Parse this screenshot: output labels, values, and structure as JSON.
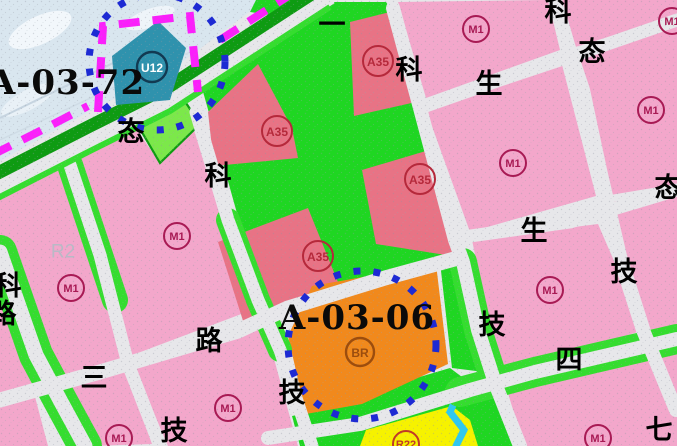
{
  "palette": {
    "road": "#e7e7ea",
    "pink": "#f3a7cb",
    "red": "#e87385",
    "green": "#1fd622",
    "lgreen": "#7ce84a",
    "strip-green": "#35dd2f",
    "dgreen": "#0e9b12",
    "orange": "#f1891c",
    "teal": "#2f92ad",
    "yellow": "#f6f200",
    "cyan": "#2fc8f0",
    "magenta": "#fb1ffb",
    "blue": "#1d2ad3",
    "icy": "#d9e6ef",
    "m1-ink": "#a81a54",
    "a35-ink": "#b5293b",
    "br-ink": "#9c4d0e",
    "u12-ink": "#123a52",
    "r22-ink": "#c03a28",
    "char-ink": "#000000"
  },
  "zone_callouts": [
    {
      "id": "A-03-72",
      "x": 67,
      "y": 83
    },
    {
      "id": "A-03-06",
      "x": 357,
      "y": 318
    }
  ],
  "road_name_chars": [
    {
      "ch": "一",
      "x": 332,
      "y": 25
    },
    {
      "ch": "态",
      "x": 131,
      "y": 132
    },
    {
      "ch": "科",
      "x": 409,
      "y": 70
    },
    {
      "ch": "科",
      "x": 558,
      "y": 12
    },
    {
      "ch": "态",
      "x": 592,
      "y": 52
    },
    {
      "ch": "生",
      "x": 489,
      "y": 84
    },
    {
      "ch": "科",
      "x": 218,
      "y": 176
    },
    {
      "ch": "态",
      "x": 668,
      "y": 188
    },
    {
      "ch": "生",
      "x": 534,
      "y": 231
    },
    {
      "ch": "技",
      "x": 624,
      "y": 272
    },
    {
      "ch": "科",
      "x": 8,
      "y": 286
    },
    {
      "ch": "路",
      "x": 3,
      "y": 314
    },
    {
      "ch": "三",
      "x": 94,
      "y": 378
    },
    {
      "ch": "路",
      "x": 209,
      "y": 341
    },
    {
      "ch": "技",
      "x": 174,
      "y": 431
    },
    {
      "ch": "技",
      "x": 292,
      "y": 393
    },
    {
      "ch": "技",
      "x": 492,
      "y": 325
    },
    {
      "ch": "四",
      "x": 569,
      "y": 360
    },
    {
      "ch": "七",
      "x": 659,
      "y": 430
    }
  ],
  "parcel_labels": [
    {
      "code": "M1",
      "type": "M1",
      "x": 476,
      "y": 29,
      "r": 13
    },
    {
      "code": "M1",
      "type": "M1",
      "x": 672,
      "y": 21,
      "r": 13
    },
    {
      "code": "M1",
      "type": "M1",
      "x": 651,
      "y": 110,
      "r": 13
    },
    {
      "code": "M1",
      "type": "M1",
      "x": 513,
      "y": 163,
      "r": 13
    },
    {
      "code": "M1",
      "type": "M1",
      "x": 550,
      "y": 290,
      "r": 13
    },
    {
      "code": "M1",
      "type": "M1",
      "x": 598,
      "y": 438,
      "r": 13
    },
    {
      "code": "M1",
      "type": "M1",
      "x": 228,
      "y": 408,
      "r": 13
    },
    {
      "code": "M1",
      "type": "M1",
      "x": 119,
      "y": 438,
      "r": 13
    },
    {
      "code": "M1",
      "type": "M1",
      "x": 71,
      "y": 288,
      "r": 13
    },
    {
      "code": "M1",
      "type": "M1",
      "x": 177,
      "y": 236,
      "r": 13
    },
    {
      "code": "A35",
      "type": "A35",
      "x": 378,
      "y": 61,
      "r": 15
    },
    {
      "code": "A35",
      "type": "A35",
      "x": 277,
      "y": 131,
      "r": 15
    },
    {
      "code": "A35",
      "type": "A35",
      "x": 420,
      "y": 179,
      "r": 15
    },
    {
      "code": "A35",
      "type": "A35",
      "x": 318,
      "y": 256,
      "r": 15
    },
    {
      "code": "U12",
      "type": "U12",
      "x": 152,
      "y": 67,
      "r": 15
    },
    {
      "code": "BR",
      "type": "BR",
      "x": 360,
      "y": 352,
      "r": 14
    },
    {
      "code": "R22",
      "type": "R22",
      "x": 406,
      "y": 444,
      "r": 13
    }
  ],
  "faint_labels": [
    {
      "text": "R2",
      "x": 63,
      "y": 252
    }
  ],
  "highlight_circles": [
    {
      "cx": 157,
      "cy": 62,
      "r": 68
    },
    {
      "cx": 362,
      "cy": 345,
      "r": 74
    }
  ]
}
